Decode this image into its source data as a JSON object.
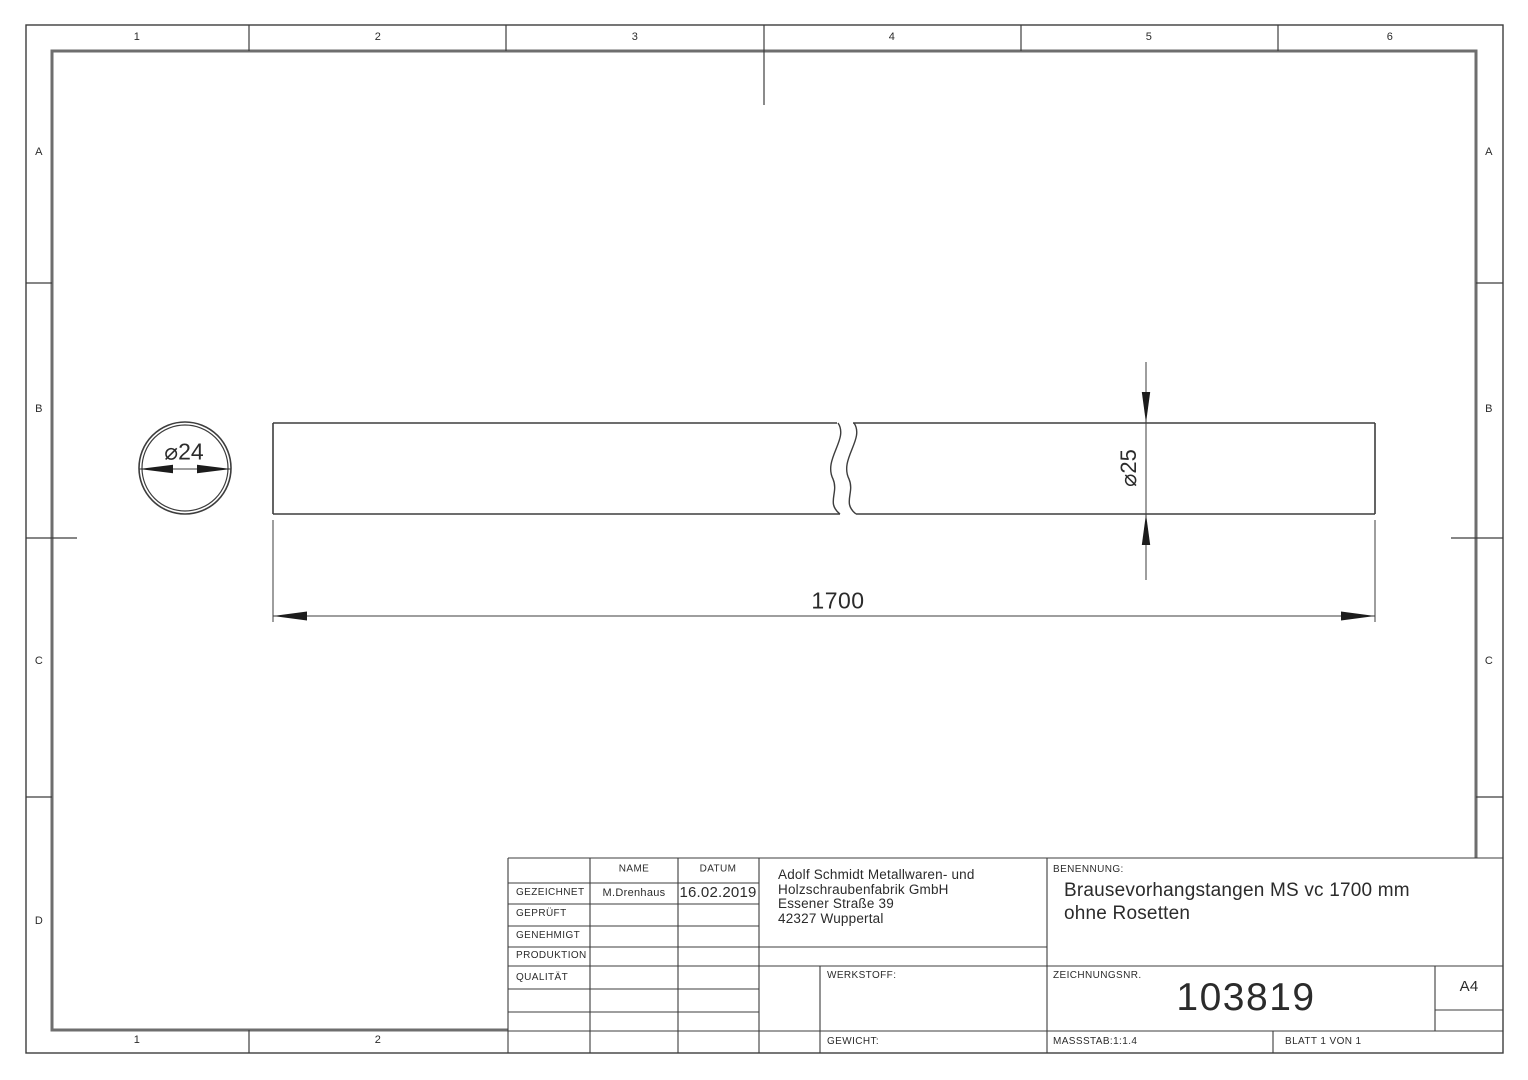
{
  "sheet": {
    "zones_top": [
      "1",
      "2",
      "3",
      "4",
      "5",
      "6"
    ],
    "zones_bottom": [
      "1",
      "2"
    ],
    "zones_left": [
      "A",
      "B",
      "C",
      "D"
    ],
    "zones_right": [
      "A",
      "B",
      "C"
    ]
  },
  "drawing": {
    "end_view_diameter": "⌀24",
    "rod_diameter": "⌀25",
    "rod_length": "1700"
  },
  "title_block": {
    "headers": {
      "name": "NAME",
      "date": "DATUM"
    },
    "approvals": [
      {
        "role": "GEZEICHNET",
        "name": "M.Drenhaus",
        "date": "16.02.2019"
      },
      {
        "role": "GEPRÜFT",
        "name": "",
        "date": ""
      },
      {
        "role": "GENEHMIGT",
        "name": "",
        "date": ""
      },
      {
        "role": "PRODUKTION",
        "name": "",
        "date": ""
      },
      {
        "role": "QUALITÄT",
        "name": "",
        "date": ""
      }
    ],
    "company": {
      "line1": "Adolf Schmidt Metallwaren- und",
      "line2": "Holzschraubenfabrik GmbH",
      "line3": "Essener Straße 39",
      "line4": "42327 Wuppertal"
    },
    "material_label": "WERKSTOFF:",
    "weight_label": "GEWICHT:",
    "title_label": "BENENNUNG:",
    "title_line1": "Brausevorhangstangen MS vc 1700 mm",
    "title_line2": "ohne Rosetten",
    "drawing_number_label": "ZEICHNUNGSNR.",
    "drawing_number": "103819",
    "paper_format": "A4",
    "scale": "MASSSTAB:1:1.4",
    "sheet_info": "BLATT 1 VON 1"
  },
  "colors": {
    "line": "#3d3d3d",
    "frame": "#6e6e6e",
    "text": "#2b2b2b",
    "background": "#ffffff"
  }
}
